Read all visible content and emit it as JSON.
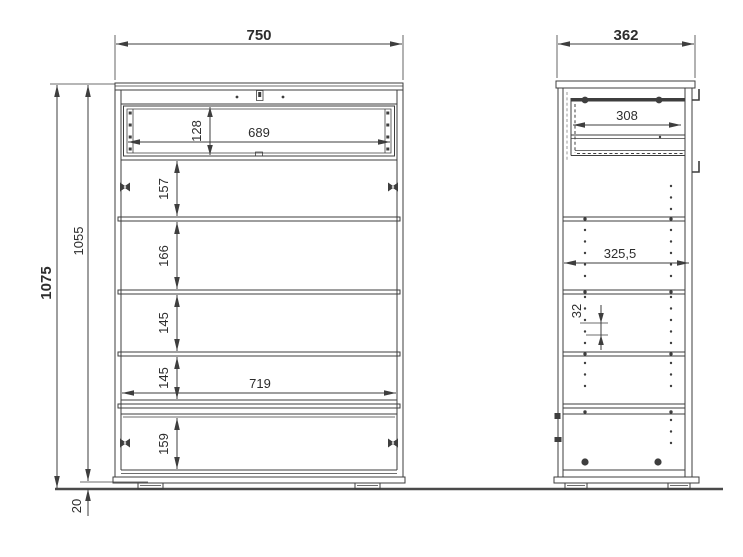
{
  "front_view": {
    "width": "750",
    "total_height": "1075",
    "carcass_height": "1055",
    "plinth_height": "20",
    "drawer_front_height": "128",
    "drawer_width": "689",
    "interior_width": "719",
    "sections": [
      "157",
      "166",
      "145",
      "145",
      "159"
    ]
  },
  "side_view": {
    "depth": "362",
    "drawer_depth": "308",
    "interior_depth": "325,5",
    "hole_pitch": "32"
  },
  "colors": {
    "line": "#3e3e3e",
    "text": "#2d2d2d",
    "ground": "#4a4a4a",
    "background": "#ffffff"
  }
}
